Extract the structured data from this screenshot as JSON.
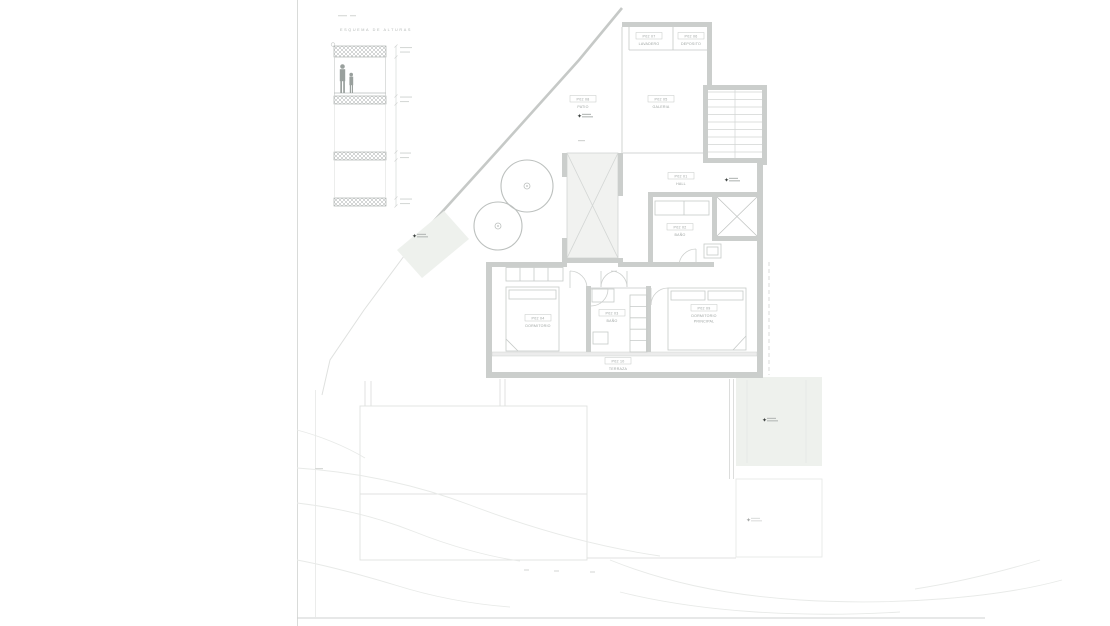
{
  "sheet": {
    "section_detail_title": "ESQUEMA DE ALTURAS"
  },
  "rooms": {
    "lavadero": {
      "code": "P02 07",
      "name": "LAVADERO"
    },
    "deposito": {
      "code": "P02 06",
      "name": "DEPOSITO"
    },
    "patio": {
      "code": "P02 08",
      "name": "PATIO"
    },
    "galeria": {
      "code": "P02 05",
      "name": "GALERIA"
    },
    "hall": {
      "code": "P02 01",
      "name": "HALL"
    },
    "bano_superior": {
      "code": "P02 02",
      "name": "BAÑO"
    },
    "bano": {
      "code": "P02 03",
      "name": "BAÑO"
    },
    "dormitorio": {
      "code": "P02 04",
      "name": "DORMITORIO"
    },
    "dormitorio_principal": {
      "code": "P02 09",
      "name_line1": "DORMITORIO",
      "name_line2": "PRINCIPAL"
    },
    "terraza": {
      "code": "P02 10",
      "name": "TERRAZA"
    }
  },
  "logo": {
    "glyph": "✦"
  },
  "colors": {
    "background": "#ffffff",
    "wall": "#cbcecc",
    "thin_line": "#cfd2d0",
    "label_text": "#9da3a1",
    "green_area": "#eef1ed",
    "contour": "#e8eae8",
    "logo_mark": "#3c413f"
  }
}
